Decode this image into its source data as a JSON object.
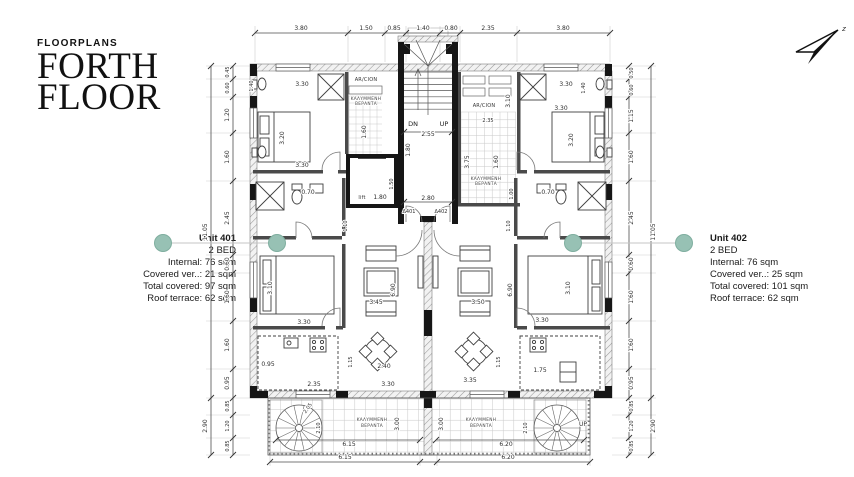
{
  "header": {
    "eyebrow": "FLOORPLANS",
    "title_line1": "FORTH",
    "title_line2": "FLOOR"
  },
  "units": {
    "unit401": {
      "name": "Unit 401",
      "type": "2 BED",
      "internal": "Internal: 76 sqm",
      "covered_ver": "Covered ver..: 21 sqm",
      "total_covered": "Total covered:  97 sqm",
      "roof_terrace": "Roof terrace: 62 sqm"
    },
    "unit402": {
      "name": "Unit 402",
      "type": "2 BED",
      "internal": "Internal: 76 sqm",
      "covered_ver": "Covered ver..: 25 sqm",
      "total_covered": "Total covered:  101 sqm",
      "roof_terrace": "Roof terrace: 62 sqm"
    }
  },
  "plan": {
    "top_dims": [
      "3.80",
      "1.50",
      "0.85",
      "1.40",
      "0.80",
      "2.35",
      "3.80"
    ],
    "left_dims": [
      "0.45",
      "0.60",
      "1.20",
      "1.60",
      "2.45",
      "0.60",
      "1.60",
      "1.60",
      "0.95"
    ],
    "left_total": "11.05",
    "left_lower_dims": [
      "0.85",
      "1.20",
      "0.85"
    ],
    "left_lower_total": "2.90",
    "right_dims": [
      "0.50",
      "0.60",
      "1.15",
      "1.60",
      "2.45",
      "0.60",
      "1.60",
      "1.60",
      "0.95"
    ],
    "right_total": "11.05",
    "right_lower_dims": [
      "0.85",
      "1.20",
      "0.85"
    ],
    "right_lower_total": "2.90",
    "bottom_dims": [
      "6.15",
      "6.20"
    ],
    "compass": "z",
    "labels": {
      "dn": "DN",
      "up": "UP",
      "stair_w": "2.55",
      "hall_l": "1.80",
      "hall_w": "2.80",
      "lift": "lift",
      "lift_dim": "1.80",
      "lift_side": "1.50",
      "door_l": "Δ401",
      "door_r": "Δ402",
      "arcion_l": "AR/CION",
      "arcion_r": "AR/CION",
      "arcion_r_dim": "3.10",
      "strip_dim": "1.60",
      "blk_top": "2.35",
      "blk_h": "3.75",
      "blk_w": "1.60",
      "blk_d": "1.00",
      "mini_ver_l1": "ΚΑΛΥΜΜΕΝΗ",
      "mini_ver_l2": "ΒΕΡΑΝΤΑ",
      "mini_ver_r1": "ΚΑΛΥΜΜΕΝΗ",
      "mini_ver_r2": "ΒΕΡΑΝΤΑ",
      "bed1l_top": "3.30",
      "bed1l_side": "1.40",
      "bed1l_len": "3.20",
      "bed1l_bot": "3.30",
      "bed1r_top": "3.30",
      "bed1r_side": "1.40",
      "bed1r_len": "3.20",
      "bed1r_bot": "3.30",
      "bath_l": "0.70",
      "bath_r": "0.70",
      "hall1_l": "1.10",
      "hall1_r": "1.10",
      "bed2l_len": "3.10",
      "bed2l_bot": "3.30",
      "bed2r_len": "3.10",
      "bed2r_bot": "3.30",
      "liv_l_w": "3.45",
      "liv_l_h": "6.90",
      "liv_r_w": "3.50",
      "liv_r_h": "6.90",
      "din_l": "2.40",
      "din_l_d": "1.15",
      "din_r_d": "1.15",
      "kit_l": "2.35",
      "kit_l2": "0.95",
      "kit_r": "1.75",
      "bot_l": "3.30",
      "bot_r": "3.35",
      "ver_l1": "ΚΑΛΥΜΜΕΝΗ",
      "ver_l2": "ΒΕΡΑΝΤΑ",
      "ver_r1": "ΚΑΛΥΜΜΕΝΗ",
      "ver_r2": "ΒΕΡΑΝΤΑ",
      "ver_l_d": "3.00",
      "ver_r_d": "3.00",
      "ver_l_w": "6.15",
      "ver_r_w": "6.20",
      "sp_l1": "2.05",
      "sp_l2": "2.10",
      "sp_r": "2.10",
      "sp_up": "UP"
    }
  }
}
